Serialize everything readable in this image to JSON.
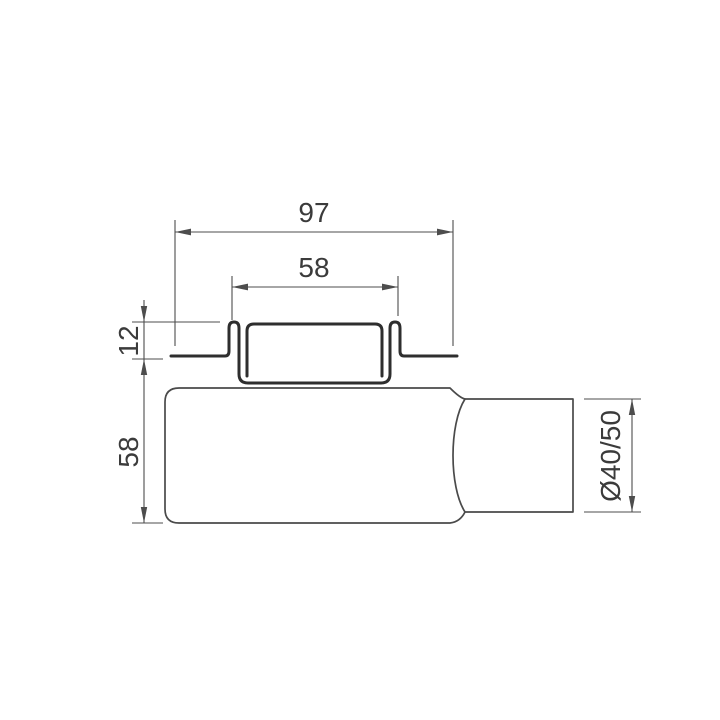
{
  "drawing": {
    "labels": {
      "overall_width": "97",
      "grate_width": "58",
      "flange_height": "12",
      "body_height": "58",
      "outlet_diameter": "Ø40/50"
    },
    "colors": {
      "outline_heavy": "#2e2e2e",
      "outline_light": "#4a4a4a",
      "dimension_line": "#4d4d4d",
      "label_text": "#3b3b3b",
      "background": "#ffffff"
    }
  }
}
